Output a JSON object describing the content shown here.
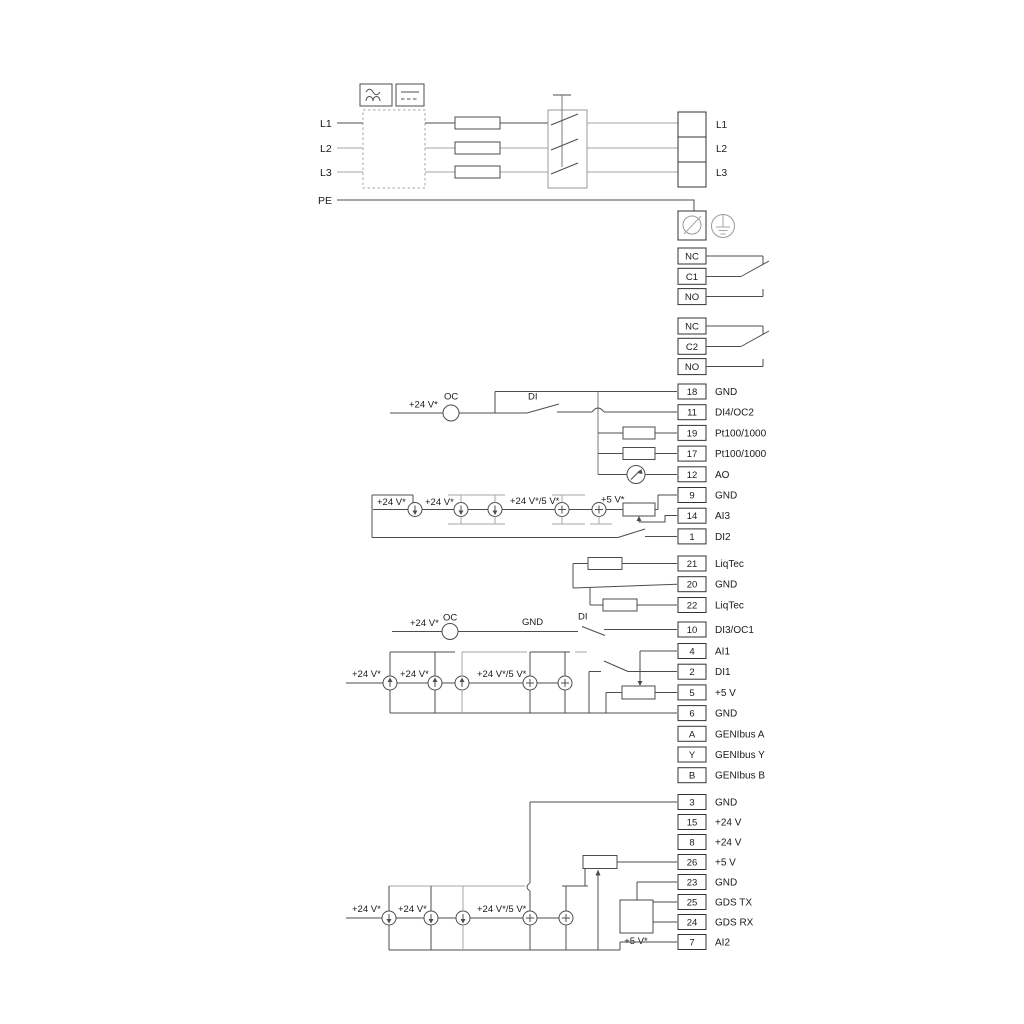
{
  "diagram": {
    "left_labels": {
      "l1": "L1",
      "l2": "L2",
      "l3": "L3",
      "pe": "PE"
    },
    "mains_block": {
      "l1": "L1",
      "l2": "L2",
      "l3": "L3"
    },
    "relay1": {
      "nc": "NC",
      "c": "C1",
      "no": "NO"
    },
    "relay2": {
      "nc": "NC",
      "c": "C2",
      "no": "NO"
    },
    "strip_a": {
      "items": [
        {
          "num": "18",
          "label": "GND"
        },
        {
          "num": "11",
          "label": "DI4/OC2"
        },
        {
          "num": "19",
          "label": "Pt100/1000"
        },
        {
          "num": "17",
          "label": "Pt100/1000"
        },
        {
          "num": "12",
          "label": "AO"
        },
        {
          "num": "9",
          "label": "GND"
        },
        {
          "num": "14",
          "label": "AI3"
        },
        {
          "num": "1",
          "label": "DI2"
        }
      ]
    },
    "strip_liqtec": {
      "items": [
        {
          "num": "21",
          "label": "LiqTec"
        },
        {
          "num": "20",
          "label": "GND"
        },
        {
          "num": "22",
          "label": "LiqTec"
        }
      ]
    },
    "strip_di3": {
      "items": [
        {
          "num": "10",
          "label": "DI3/OC1"
        }
      ]
    },
    "strip_comm": {
      "items": [
        {
          "num": "4",
          "label": "AI1"
        },
        {
          "num": "2",
          "label": "DI1"
        },
        {
          "num": "5",
          "label": "+5 V"
        },
        {
          "num": "6",
          "label": "GND"
        },
        {
          "num": "A",
          "label": "GENIbus A"
        },
        {
          "num": "Y",
          "label": "GENIbus Y"
        },
        {
          "num": "B",
          "label": "GENIbus B"
        }
      ]
    },
    "strip_bottom": {
      "items": [
        {
          "num": "3",
          "label": "GND"
        },
        {
          "num": "15",
          "label": "+24 V"
        },
        {
          "num": "8",
          "label": "+24 V"
        },
        {
          "num": "26",
          "label": "+5 V"
        },
        {
          "num": "23",
          "label": "GND"
        },
        {
          "num": "25",
          "label": "GDS TX"
        },
        {
          "num": "24",
          "label": "GDS RX"
        },
        {
          "num": "7",
          "label": "AI2"
        }
      ]
    },
    "oc_row1": {
      "v24": "+24 V*",
      "oc": "OC",
      "di": "DI"
    },
    "oc_row2": {
      "v24": "+24 V*",
      "oc": "OC",
      "gnd": "GND",
      "di": "DI"
    },
    "src_row1": {
      "v24a": "+24 V*",
      "v24b": "+24 V*",
      "v245": "+24 V*/5 V*",
      "v5": "+5 V*"
    },
    "src_row2": {
      "v24a": "+24 V*",
      "v24b": "+24 V*",
      "v245": "+24 V*/5 V*"
    },
    "src_row3": {
      "v24a": "+24 V*",
      "v24b": "+24 V*",
      "v245": "+24 V*/5 V*",
      "gds": "+5 V*"
    },
    "colors": {
      "wire": "#4d4d4d",
      "wire_gray": "#a6a6a6",
      "text": "#1a1a1a",
      "background": "#ffffff"
    }
  }
}
